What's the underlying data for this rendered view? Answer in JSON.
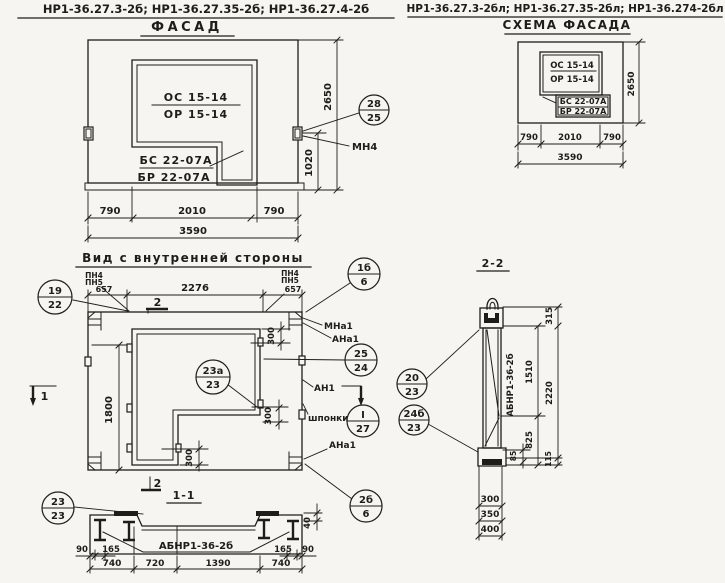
{
  "headers": {
    "left": "НР1-36.27.3-2б; НР1-36.27.35-2б; НР1-36.27.4-2б",
    "right": "НР1-36.27.3-2бл; НР1-36.27.35-2бл; НР1-36.274-2бл"
  },
  "facade": {
    "title": "ФАСАД",
    "os": "ОС 15-14",
    "or": "ОР 15-14",
    "bs": "БС 22-07А",
    "br": "БР 22-07А",
    "mn4": "МН4",
    "dim_2650": "2650",
    "dim_1020": "1020",
    "dim_790l": "790",
    "dim_2010": "2010",
    "dim_790r": "790",
    "dim_3590": "3590"
  },
  "scheme": {
    "title": "СХЕМА ФАСАДА",
    "os": "ОС 15-14",
    "or": "ОР 15-14",
    "bs": "БС 22-07А",
    "br": "БР 22-07А",
    "dim_2650": "2650",
    "dim_790l": "790",
    "dim_2010": "2010",
    "dim_790r": "790",
    "dim_3590": "3590"
  },
  "inner": {
    "title": "Вид с внутренней стороны",
    "pn4": "ПН4",
    "pn5": "ПН5",
    "dim_657l": "657",
    "dim_2276": "2276",
    "dim_657r": "657",
    "dim_1800": "1800",
    "dim_300": "300",
    "mna1": "МНа1",
    "ana1": "АНа1",
    "an1": "АН1",
    "shponki": "шпонки",
    "ana1_b": "АНа1",
    "sec1": "1",
    "sec2": "2"
  },
  "s11": {
    "title": "1-1",
    "label": "АБНР1-36-2б",
    "d90": "90",
    "d165": "165",
    "d740": "740",
    "d720": "720",
    "d1390": "1390",
    "d740b": "740",
    "d165r": "165",
    "d90r": "90",
    "d40": "40"
  },
  "s22": {
    "title": "2-2",
    "label": "АБНР1-36-2б",
    "d315": "315",
    "d1510": "1510",
    "d2220": "2220",
    "d825": "825",
    "d115": "115",
    "d85": "85",
    "d300": "300",
    "d350": "350",
    "d400": "400"
  },
  "callouts": {
    "c28_25": {
      "top": "28",
      "bottom": "25"
    },
    "c19_22": {
      "top": "19",
      "bottom": "22"
    },
    "c1b_6": {
      "top": "1б",
      "bottom": "6"
    },
    "c25_24": {
      "top": "25",
      "bottom": "24"
    },
    "c23a_23": {
      "top": "23а",
      "bottom": "23"
    },
    "cI_27": {
      "top": "I",
      "bottom": "27"
    },
    "c2b_6": {
      "top": "2б",
      "bottom": "6"
    },
    "c23_23": {
      "top": "23",
      "bottom": "23"
    },
    "c20_23": {
      "top": "20",
      "bottom": "23"
    },
    "c24b_23": {
      "top": "24б",
      "bottom": "23"
    }
  },
  "colors": {
    "ink": "#1f1d1a",
    "paper": "#f6f5f1"
  }
}
